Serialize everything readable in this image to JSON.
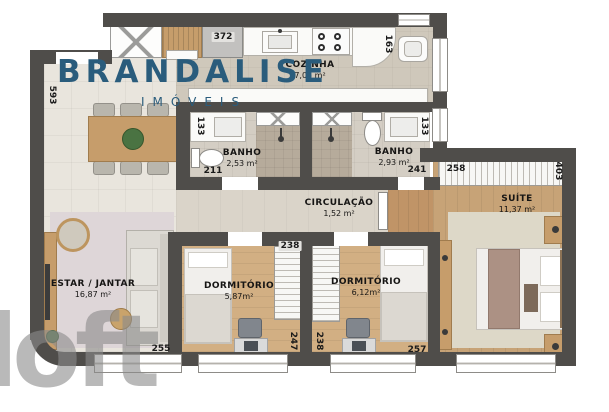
{
  "brand": {
    "name": "BRANDALISE",
    "subtitle": "IMÓVEIS",
    "brand_color": "#2a5c7c"
  },
  "watermark": {
    "text": "loft",
    "color": "#8b8b8b"
  },
  "rooms": {
    "estar": {
      "name": "ESTAR / JANTAR",
      "area": "16,87 m²"
    },
    "cozinha": {
      "name": "COZINHA",
      "area": "7,05 m²"
    },
    "banho1": {
      "name": "BANHO",
      "area": "2,53 m²"
    },
    "banho2": {
      "name": "BANHO",
      "area": "2,93 m²"
    },
    "circulacao": {
      "name": "CIRCULAÇÃO",
      "area": "1,52 m²"
    },
    "suite": {
      "name": "SUÍTE",
      "area": "11,37 m²"
    },
    "dorm1": {
      "name": "DORMITÓRIO",
      "area": "5,87m²"
    },
    "dorm2": {
      "name": "DORMITÓRIO",
      "area": "6,12m²"
    }
  },
  "dimensions": {
    "left_wall": "593",
    "fridge": "372",
    "kitchen_right": "163",
    "banho1_width": "133",
    "banho1_bottom": "211",
    "banho2_width": "133",
    "banho2_bottom": "241",
    "suite_closet": "258",
    "suite_right": "403",
    "dorm1_closet": "238",
    "dorm1_right": "247",
    "dorm2_left": "238",
    "dorm2_bottom": "257",
    "estar_bottom": "255"
  },
  "palette": {
    "wall": "#4f4d4a",
    "wood": "#d2af83",
    "tile": "#e9e5dd"
  }
}
